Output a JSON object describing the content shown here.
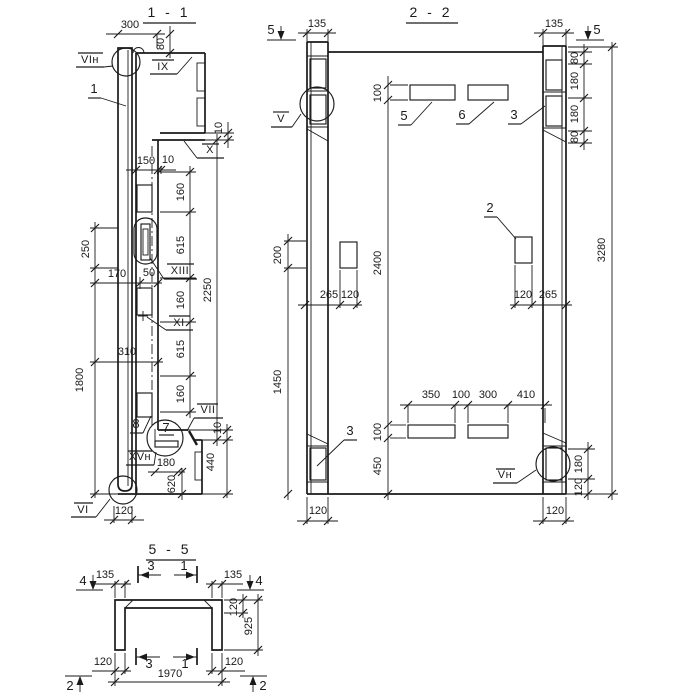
{
  "palette": {
    "ink": "#1a1a1a",
    "paper": "#ffffff"
  },
  "v11": {
    "title": "1 - 1",
    "m_vin": "VIн",
    "m_ix": "IX",
    "m_x": "X",
    "m_xiii": "XIII",
    "m_xi": "XI",
    "m_vii": "VII",
    "m_xvn": "XVн",
    "m_vi": "VI",
    "p1": "1",
    "p7": "7",
    "p8": "8",
    "d300": "300",
    "d80": "80",
    "d10a": "10",
    "d150": "150",
    "d10b": "10",
    "d160a": "160",
    "d615a": "615",
    "d160b": "160",
    "d615b": "615",
    "d160c": "160",
    "d2250": "2250",
    "d250": "250",
    "d1800": "1800",
    "d170": "170",
    "d50": "50",
    "d310": "310",
    "d180": "180",
    "d620": "620",
    "d10c": "10",
    "d440": "440",
    "d120": "120"
  },
  "v22": {
    "title": "2 - 2",
    "m_v": "V",
    "m_vn": "Vн",
    "s5l": "5",
    "s5r": "5",
    "p5": "5",
    "p6": "6",
    "p3t": "3",
    "p2": "2",
    "p3b": "3",
    "d135l": "135",
    "d135r": "135",
    "d80a": "80",
    "d180a": "180",
    "d180b": "180",
    "d80b": "80",
    "d3280": "3280",
    "d100t": "100",
    "d2400": "2400",
    "d100b": "100",
    "d450": "450",
    "d200": "200",
    "d1450": "1450",
    "d265l": "265",
    "d120l": "120",
    "d120r": "120",
    "d265r": "265",
    "d350": "350",
    "d100m": "100",
    "d300": "300",
    "d410": "410",
    "d180r": "180",
    "d120rb": "120",
    "d120cl": "120",
    "d120cr": "120"
  },
  "v55": {
    "title": "5 - 5",
    "s4l": "4",
    "s4r": "4",
    "s3t": "3",
    "s1t": "1",
    "s3b": "3",
    "s1b": "1",
    "s2l": "2",
    "s2r": "2",
    "d135l": "135",
    "d135r": "135",
    "d120t": "120",
    "d925": "925",
    "d120bl": "120",
    "d120br": "120",
    "d1970": "1970"
  }
}
